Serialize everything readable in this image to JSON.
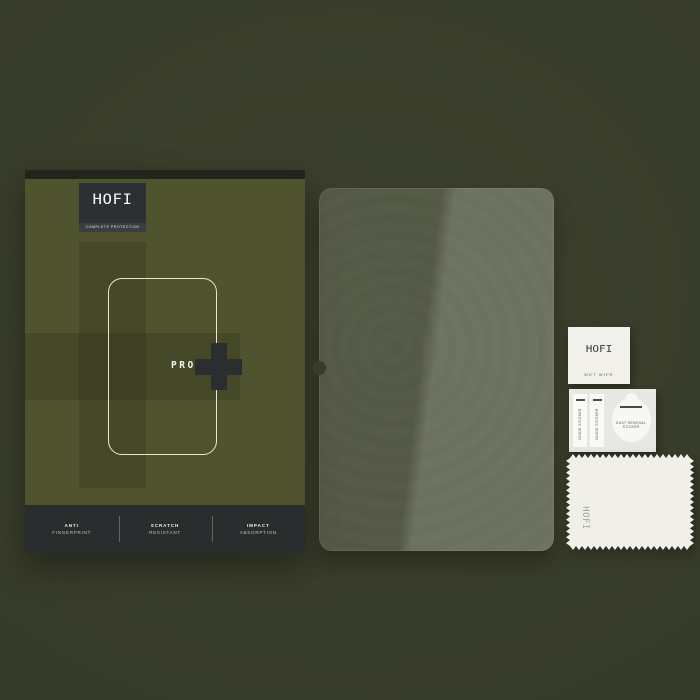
{
  "colors": {
    "background": "#373b29",
    "box_face": "#4f532e",
    "panel_dark": "#2c3032",
    "outline_cream": "#e9e6d4",
    "card_white": "#f1f0ea"
  },
  "box": {
    "brand": "HOFI",
    "tagline": "COMPLETE PROTECTION",
    "model": "PRO",
    "features": [
      {
        "title": "ANTI",
        "subtitle": "FINGERPRINT"
      },
      {
        "title": "SCRATCH",
        "subtitle": "RESISTANT"
      },
      {
        "title": "IMPACT",
        "subtitle": "ABSORPTION"
      }
    ]
  },
  "accessories": {
    "wet_wipe": {
      "brand": "HOFI",
      "label": "WET WIPE"
    },
    "sticker_sheet": {
      "guide_sticker_1": "GUIDE STICKER",
      "guide_sticker_2": "GUIDE STICKER",
      "dust_removal_sticker": "DUST REMOVAL STICKER"
    },
    "cloth": {
      "brand": "HOFI"
    }
  }
}
